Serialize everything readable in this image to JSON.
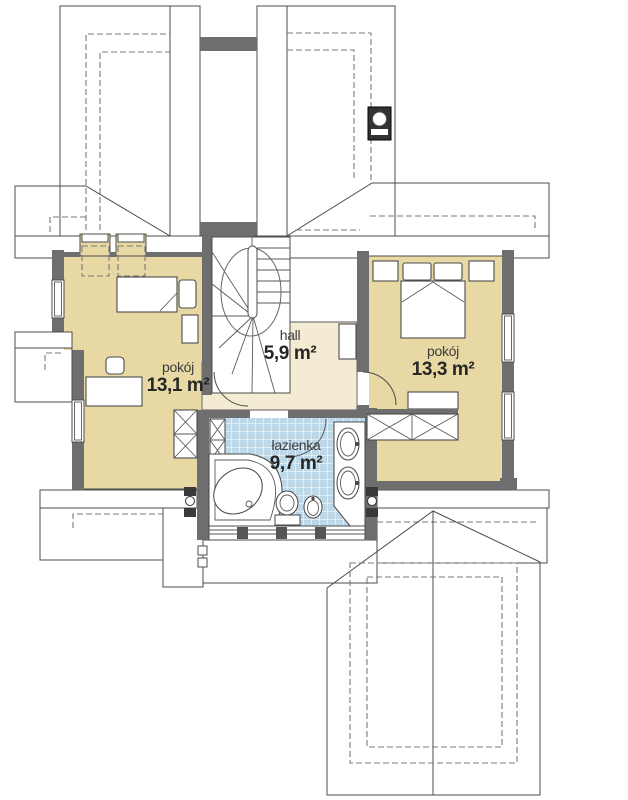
{
  "plan": {
    "title": "floor plan – upper storey",
    "rooms": [
      {
        "name": "pokój",
        "area": "13,1 m²"
      },
      {
        "name": "hall",
        "area": "5,9 m²"
      },
      {
        "name": "pokój",
        "area": "13,3 m²"
      },
      {
        "name": "łazienka",
        "area": "9,7 m²"
      }
    ],
    "colors": {
      "room_fill": "#e8d8a4",
      "hall_fill": "#f3ecd2",
      "bath_tile": "#bdd8e8",
      "wall": "#6e6e6e",
      "roof_light": "#dadada",
      "roof_dark": "#a6a6a6",
      "roof_pale": "#e3e3e3",
      "roof_gable": "#d3d3d3",
      "outline": "#4c4c4c"
    }
  }
}
